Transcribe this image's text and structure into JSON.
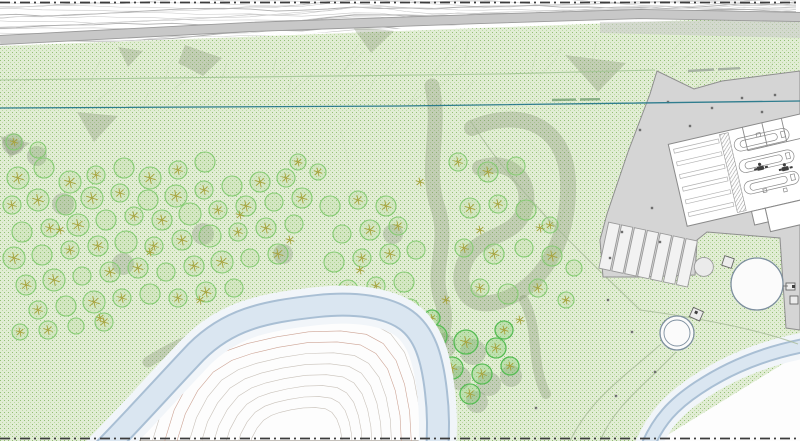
{
  "document": {
    "kind": "landscape-site-plan-drawing",
    "visible_text": "none-legible",
    "illegible_labels": [
      {
        "name": "pipeline-label",
        "x": 552,
        "y": 100
      },
      {
        "name": "boundary-label",
        "x": 688,
        "y": 71
      }
    ]
  },
  "palette": {
    "paper": "#ffffff",
    "green_base": "#e1edd4",
    "green_dot_a": "#94bf76",
    "green_dot_b": "#bcd8a2",
    "road_fill": "#c8c8c8",
    "road_edge": "#9b9b9b",
    "paved_fill": "#d5d5d5",
    "paved_edge": "#8f8f8f",
    "building_fill": "#ffffff",
    "building_line": "#8a8a8a",
    "river_fill": "#dae6f1",
    "river_edge": "#a9bfd4",
    "river_halo": "#f1f5f9",
    "bank_fill": "#fdfdfd",
    "contour_line": "#c7c7c7",
    "contour_dark": "#aeaeae",
    "terrain_contour": "#c3bbb2",
    "terrain_contour_red": "#c89a8a",
    "promontory_outline": "#8a8278",
    "pipeline_teal": "#2f7d8e",
    "utility_green_line": "#a4c596",
    "track_line": "#a9bb9a",
    "slope_line": "#c5d8b5",
    "shade_patch": "rgba(122,136,106,0.30)",
    "tree_stroke": "#86cc74",
    "tree_fill": "rgba(154,205,124,0.18)",
    "tree_bright": "#57bd55",
    "tree_bright_fill": "rgba(120,200,100,0.32)",
    "tree_star": "#a8a23c",
    "shadow_fill": "rgba(118,124,112,0.28)",
    "boundary_line": "#3c3c3c",
    "survey_dot": "#6f6f6f",
    "tank_ring": "#7d8f9f"
  },
  "site_plan": {
    "trees": [
      [
        18,
        178,
        11
      ],
      [
        44,
        168,
        10
      ],
      [
        70,
        182,
        11
      ],
      [
        96,
        175,
        9
      ],
      [
        124,
        168,
        10
      ],
      [
        150,
        178,
        11
      ],
      [
        178,
        170,
        9
      ],
      [
        205,
        162,
        10
      ],
      [
        12,
        205,
        9
      ],
      [
        38,
        200,
        11
      ],
      [
        66,
        205,
        10
      ],
      [
        92,
        198,
        11
      ],
      [
        120,
        193,
        9
      ],
      [
        148,
        200,
        10
      ],
      [
        176,
        196,
        11
      ],
      [
        204,
        190,
        9
      ],
      [
        232,
        186,
        10
      ],
      [
        260,
        182,
        10
      ],
      [
        286,
        178,
        9
      ],
      [
        22,
        232,
        10
      ],
      [
        50,
        228,
        9
      ],
      [
        78,
        225,
        11
      ],
      [
        106,
        220,
        10
      ],
      [
        134,
        216,
        9
      ],
      [
        162,
        220,
        10
      ],
      [
        190,
        214,
        11
      ],
      [
        218,
        210,
        9
      ],
      [
        246,
        206,
        10
      ],
      [
        274,
        202,
        9
      ],
      [
        302,
        198,
        10
      ],
      [
        14,
        258,
        11
      ],
      [
        42,
        255,
        10
      ],
      [
        70,
        250,
        9
      ],
      [
        98,
        246,
        10
      ],
      [
        126,
        242,
        11
      ],
      [
        154,
        246,
        9
      ],
      [
        182,
        240,
        10
      ],
      [
        210,
        236,
        11
      ],
      [
        238,
        232,
        9
      ],
      [
        266,
        228,
        10
      ],
      [
        294,
        224,
        9
      ],
      [
        26,
        285,
        10
      ],
      [
        54,
        280,
        11
      ],
      [
        82,
        276,
        9
      ],
      [
        110,
        272,
        10
      ],
      [
        138,
        268,
        10
      ],
      [
        166,
        272,
        9
      ],
      [
        194,
        266,
        10
      ],
      [
        222,
        262,
        11
      ],
      [
        250,
        258,
        9
      ],
      [
        278,
        254,
        10
      ],
      [
        38,
        310,
        9
      ],
      [
        66,
        306,
        10
      ],
      [
        94,
        302,
        11
      ],
      [
        122,
        298,
        9
      ],
      [
        150,
        294,
        10
      ],
      [
        178,
        298,
        9
      ],
      [
        206,
        292,
        10
      ],
      [
        234,
        288,
        9
      ],
      [
        20,
        332,
        8
      ],
      [
        48,
        330,
        9
      ],
      [
        76,
        326,
        8
      ],
      [
        104,
        322,
        9
      ],
      [
        14,
        142,
        8
      ],
      [
        38,
        150,
        8
      ],
      [
        298,
        162,
        8
      ],
      [
        318,
        172,
        8
      ],
      [
        330,
        206,
        10
      ],
      [
        358,
        200,
        9
      ],
      [
        386,
        206,
        10
      ],
      [
        342,
        234,
        9
      ],
      [
        370,
        230,
        10
      ],
      [
        398,
        226,
        9
      ],
      [
        334,
        262,
        10
      ],
      [
        362,
        258,
        9
      ],
      [
        390,
        254,
        10
      ],
      [
        416,
        250,
        9
      ],
      [
        348,
        290,
        10
      ],
      [
        376,
        286,
        9
      ],
      [
        404,
        282,
        10
      ],
      [
        356,
        316,
        9
      ],
      [
        384,
        312,
        10
      ],
      [
        410,
        308,
        9
      ],
      [
        458,
        162,
        9
      ],
      [
        488,
        172,
        10
      ],
      [
        516,
        166,
        9
      ],
      [
        470,
        208,
        10
      ],
      [
        498,
        204,
        9
      ],
      [
        526,
        210,
        10
      ],
      [
        464,
        248,
        9
      ],
      [
        494,
        254,
        10
      ],
      [
        524,
        248,
        9
      ],
      [
        552,
        256,
        10
      ],
      [
        480,
        288,
        9
      ],
      [
        508,
        294,
        10
      ],
      [
        538,
        288,
        9
      ],
      [
        566,
        300,
        8
      ],
      [
        574,
        268,
        8
      ],
      [
        550,
        225,
        8
      ]
    ],
    "bright_trees": [
      [
        436,
        336,
        11
      ],
      [
        466,
        342,
        12
      ],
      [
        496,
        348,
        10
      ],
      [
        452,
        368,
        11
      ],
      [
        482,
        374,
        10
      ],
      [
        510,
        366,
        9
      ],
      [
        442,
        396,
        9
      ],
      [
        470,
        394,
        10
      ],
      [
        504,
        330,
        9
      ],
      [
        432,
        318,
        8
      ]
    ],
    "tree_shadows": [
      [
        10,
        140,
        10
      ],
      [
        34,
        152,
        9
      ],
      [
        60,
        200,
        10
      ],
      [
        120,
        260,
        10
      ],
      [
        200,
        230,
        10
      ],
      [
        280,
        250,
        9
      ],
      [
        440,
        342,
        12
      ],
      [
        470,
        348,
        12
      ],
      [
        456,
        374,
        11
      ],
      [
        486,
        380,
        11
      ],
      [
        474,
        398,
        10
      ],
      [
        508,
        372,
        10
      ],
      [
        350,
        300,
        9
      ],
      [
        390,
        230,
        9
      ]
    ],
    "star_marks": [
      [
        240,
        215
      ],
      [
        150,
        252
      ],
      [
        420,
        182
      ],
      [
        540,
        228
      ],
      [
        100,
        318
      ],
      [
        360,
        270
      ],
      [
        290,
        240
      ],
      [
        480,
        230
      ],
      [
        520,
        320
      ],
      [
        200,
        300
      ],
      [
        60,
        230
      ],
      [
        330,
        300
      ],
      [
        372,
        330
      ],
      [
        446,
        300
      ]
    ],
    "survey_points": [
      [
        668,
        102
      ],
      [
        690,
        126
      ],
      [
        712,
        108
      ],
      [
        742,
        98
      ],
      [
        762,
        112
      ],
      [
        680,
        182
      ],
      [
        652,
        208
      ],
      [
        700,
        198
      ],
      [
        736,
        214
      ],
      [
        660,
        242
      ],
      [
        622,
        232
      ],
      [
        610,
        258
      ],
      [
        775,
        95
      ],
      [
        792,
        160
      ],
      [
        640,
        130
      ],
      [
        608,
        300
      ],
      [
        632,
        332
      ],
      [
        655,
        372
      ],
      [
        616,
        396
      ],
      [
        536,
        408
      ]
    ],
    "shade_patches": [
      "185,45 222,58 203,76 178,63",
      "118,47 143,51 128,67",
      "77,112 118,116 94,142",
      "0,136 30,143 10,158",
      "565,55 626,63 598,92",
      "352,26 394,31 371,53"
    ],
    "shade_bands": [
      {
        "d": "M 432,86 C 442,130 424,168 438,208 C 450,246 430,268 442,302 C 450,326 438,348 428,368",
        "w": 15
      },
      {
        "d": "M 472,128 C 524,106 566,128 568,182 C 570,240 542,290 496,302 C 466,310 452,282 468,256 C 484,232 520,238 526,204 C 530,176 506,158 480,168",
        "w": 16
      },
      {
        "d": "M 148,362 C 190,336 225,326 262,320",
        "w": 11
      },
      {
        "d": "M 524,300 C 540,332 530,362 546,394",
        "w": 10
      }
    ],
    "promontory_points": "140,441 152,402 168,372 188,348 212,333 238,324 272,316 310,310 348,309 378,313 398,324 413,344 423,372 429,404 431,441",
    "parking": {
      "stall_count": 7
    },
    "contour_zone": {
      "rows": 16
    },
    "pipeline_path": "M 0,108 L 400,106 L 800,101",
    "utility_path": "M 0,80 L 500,74 L 655,70",
    "river_main_path": "M 96,458 C 130,424 160,390 196,352 C 228,320 262,312 318,306 C 356,302 388,307 406,320 C 424,333 432,356 436,392 C 439,416 438,432 437,458",
    "river_secondary_path": "M 812,344 C 765,352 728,368 698,388 C 674,404 658,420 646,450",
    "road_path": "M 0,40 L 250,27 L 480,19 L 640,14 L 800,17",
    "tracks": [
      "M 660,345 C 620,380 590,400 570,441",
      "M 676,352 C 645,385 615,405 600,441",
      "M 640,310 C 700,318 760,330 798,344",
      "M 470,120 C 520,200 600,270 640,310"
    ]
  }
}
